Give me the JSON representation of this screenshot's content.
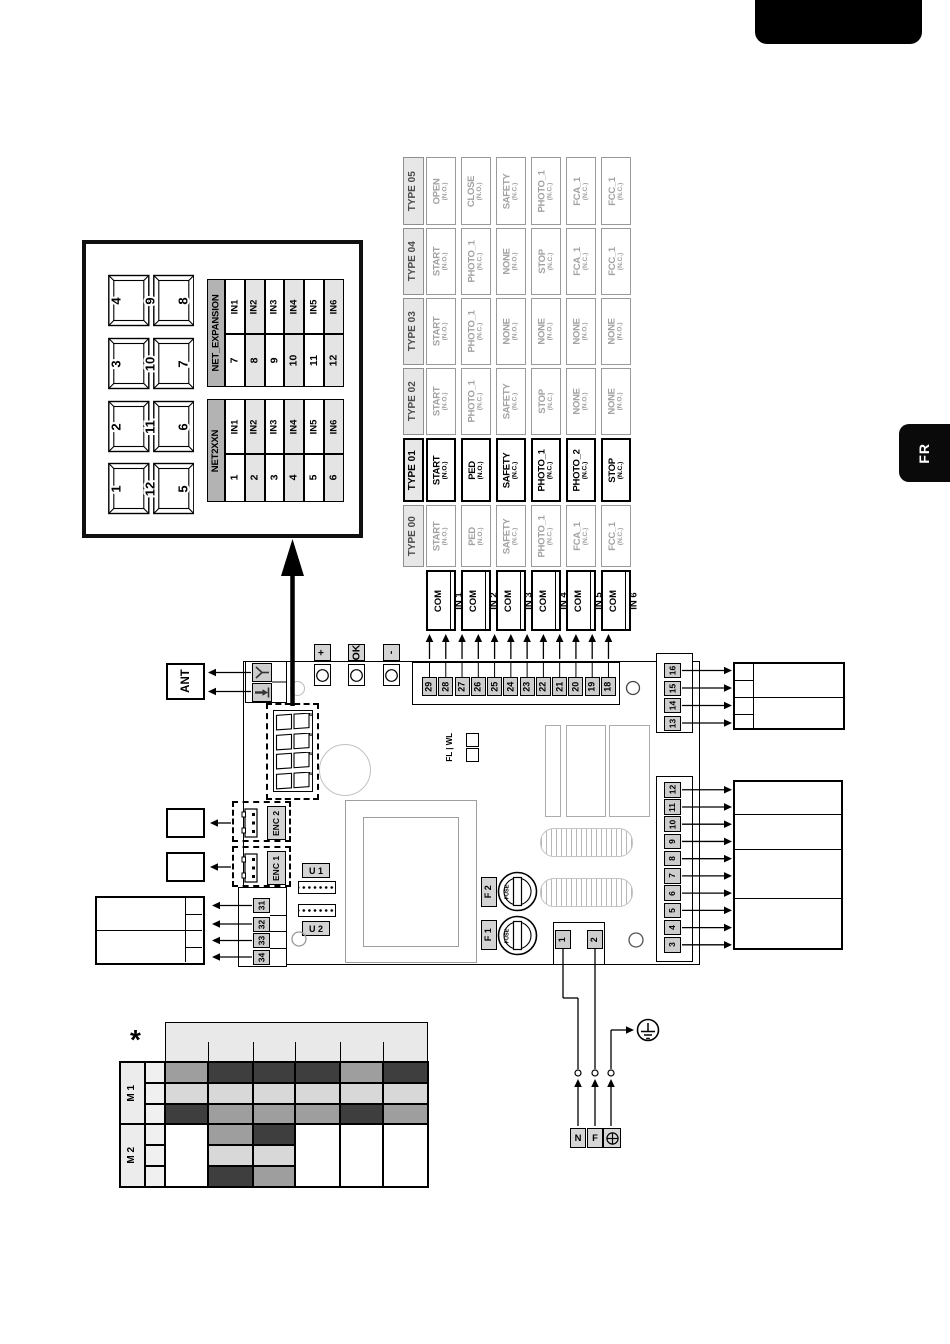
{
  "page": {
    "language_tab": "FR"
  },
  "net_display_box": {
    "digit_groups": [
      {
        "top": "4",
        "mid": "9",
        "bottom": "8"
      },
      {
        "top": "3",
        "mid": "10",
        "bottom": "7"
      },
      {
        "top": "2",
        "mid": "11",
        "bottom": "6"
      },
      {
        "top": "1",
        "mid": "12",
        "bottom": "5"
      }
    ],
    "tables": [
      {
        "name": "NET_EXPANSION",
        "rows": [
          [
            "IN1",
            "7"
          ],
          [
            "IN2",
            "8"
          ],
          [
            "IN3",
            "9"
          ],
          [
            "IN4",
            "10"
          ],
          [
            "IN5",
            "11"
          ],
          [
            "IN6",
            "12"
          ]
        ]
      },
      {
        "name": "NET2XXN",
        "rows": [
          [
            "IN1",
            "1"
          ],
          [
            "IN2",
            "2"
          ],
          [
            "IN3",
            "3"
          ],
          [
            "IN4",
            "4"
          ],
          [
            "IN5",
            "5"
          ],
          [
            "IN6",
            "6"
          ]
        ]
      }
    ]
  },
  "type_table": {
    "com_label": "COM",
    "inputs": [
      "IN 1",
      "IN 2",
      "IN 3",
      "IN 4",
      "IN 5",
      "IN 6"
    ],
    "columns": [
      {
        "type": "TYPE 05",
        "selected": false,
        "functions": [
          {
            "name": "OPEN",
            "mode": "(N.O.)"
          },
          {
            "name": "CLOSE",
            "mode": "(N.O.)"
          },
          {
            "name": "SAFETY",
            "mode": "(N.C.)"
          },
          {
            "name": "PHOTO_1",
            "mode": "(N.C.)"
          },
          {
            "name": "FCA_1",
            "mode": "(N.C.)"
          },
          {
            "name": "FCC_1",
            "mode": "(N.C.)"
          }
        ]
      },
      {
        "type": "TYPE 04",
        "selected": false,
        "functions": [
          {
            "name": "START",
            "mode": "(N.O.)"
          },
          {
            "name": "PHOTO_1",
            "mode": "(N.C.)"
          },
          {
            "name": "NONE",
            "mode": "(N.O.)"
          },
          {
            "name": "STOP",
            "mode": "(N.C.)"
          },
          {
            "name": "FCA_1",
            "mode": "(N.C.)"
          },
          {
            "name": "FCC_1",
            "mode": "(N.C.)"
          }
        ]
      },
      {
        "type": "TYPE 03",
        "selected": false,
        "functions": [
          {
            "name": "START",
            "mode": "(N.O.)"
          },
          {
            "name": "PHOTO_1",
            "mode": "(N.C.)"
          },
          {
            "name": "NONE",
            "mode": "(N.O.)"
          },
          {
            "name": "NONE",
            "mode": "(N.O.)"
          },
          {
            "name": "NONE",
            "mode": "(N.O.)"
          },
          {
            "name": "NONE",
            "mode": "(N.O.)"
          }
        ]
      },
      {
        "type": "TYPE 02",
        "selected": false,
        "functions": [
          {
            "name": "START",
            "mode": "(N.O.)"
          },
          {
            "name": "PHOTO_1",
            "mode": "(N.C.)"
          },
          {
            "name": "SAFETY",
            "mode": "(N.C.)"
          },
          {
            "name": "STOP",
            "mode": "(N.C.)"
          },
          {
            "name": "NONE",
            "mode": "(N.O.)"
          },
          {
            "name": "NONE",
            "mode": "(N.O.)"
          }
        ]
      },
      {
        "type": "TYPE 01",
        "selected": true,
        "functions": [
          {
            "name": "START",
            "mode": "(N.O.)"
          },
          {
            "name": "PED",
            "mode": "(N.O.)"
          },
          {
            "name": "SAFETY",
            "mode": "(N.C.)"
          },
          {
            "name": "PHOTO_1",
            "mode": "(N.C.)"
          },
          {
            "name": "PHOTO_2",
            "mode": "(N.C.)"
          },
          {
            "name": "STOP",
            "mode": "(N.C.)"
          }
        ]
      },
      {
        "type": "TYPE 00",
        "selected": false,
        "functions": [
          {
            "name": "START",
            "mode": "(N.O.)"
          },
          {
            "name": "PED",
            "mode": "(N.O.)"
          },
          {
            "name": "SAFETY",
            "mode": "(N.C.)"
          },
          {
            "name": "PHOTO_1",
            "mode": "(N.C.)"
          },
          {
            "name": "FCA_1",
            "mode": "(N.C.)"
          },
          {
            "name": "FCC_1",
            "mode": "(N.C.)"
          }
        ]
      }
    ]
  },
  "board": {
    "ant_label": "ANT",
    "buttons": [
      "+",
      "OK",
      "-"
    ],
    "terminals_top": [
      "29",
      "28",
      "27",
      "26",
      "25",
      "24",
      "23",
      "22",
      "21",
      "20",
      "19",
      "18"
    ],
    "terminals_right_upper": [
      "16",
      "15",
      "14",
      "13"
    ],
    "terminals_right_lower": [
      "12",
      "11",
      "10",
      "9",
      "8",
      "7",
      "6",
      "5",
      "4",
      "3"
    ],
    "terminals_left": [
      "31",
      "32",
      "33",
      "34"
    ],
    "power_terminals": [
      "1",
      "2"
    ],
    "enc_labels": [
      "ENC 2",
      "ENC 1"
    ],
    "u_labels": [
      "U 1",
      "U 2"
    ],
    "fuse_labels": [
      "F 2",
      "F 1"
    ],
    "fuse_text": "FUSE",
    "fl_wl": "FL | WL"
  },
  "mains": {
    "neutral": "N",
    "phase": "F"
  },
  "motor_table": {
    "asterisk": "*",
    "groups": [
      {
        "label": "M 1",
        "rows": [
          [
            "mid",
            "dark",
            "dark",
            "dark",
            "mid",
            "dark"
          ],
          [
            "light",
            "light",
            "light",
            "light",
            "light",
            "light"
          ],
          [
            "dark",
            "mid",
            "mid",
            "mid",
            "dark",
            "mid"
          ]
        ]
      },
      {
        "label": "M 2",
        "rows": [
          [
            "white",
            "mid",
            "dark",
            "white",
            "white",
            "white"
          ],
          [
            "white",
            "light",
            "light",
            "white",
            "white",
            "white"
          ],
          [
            "white",
            "dark",
            "mid",
            "white",
            "white",
            "white"
          ]
        ]
      }
    ],
    "palette": {
      "dark": "#3e3e3e",
      "mid": "#9e9e9e",
      "light": "#d8d8d8",
      "white": "#ffffff"
    }
  }
}
